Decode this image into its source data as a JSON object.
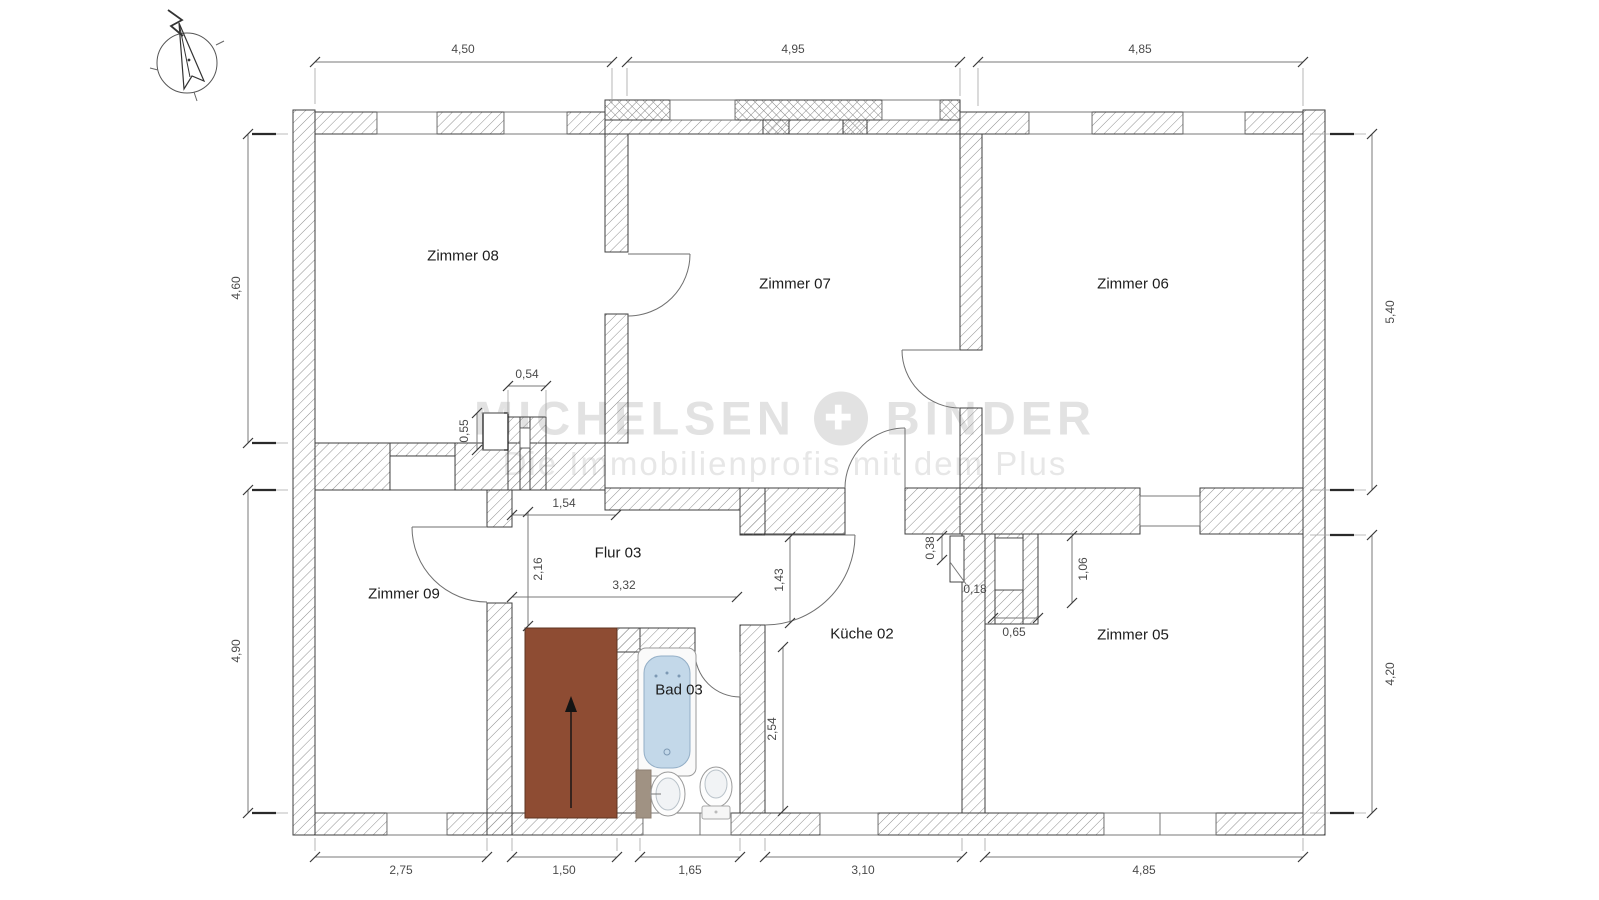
{
  "watermark": {
    "brand_left": "MICHELSEN",
    "plus_symbol": "✚",
    "brand_right": "BINDER",
    "tagline": "Die Immobilienprofis mit dem Plus"
  },
  "rooms": {
    "zimmer08": "Zimmer 08",
    "zimmer07": "Zimmer 07",
    "zimmer06": "Zimmer 06",
    "zimmer09": "Zimmer 09",
    "zimmer05": "Zimmer 05",
    "flur": "Flur 03",
    "kueche": "Küche 02",
    "bad": "Bad 03"
  },
  "dims": {
    "top1": "4,50",
    "top2": "4,95",
    "top3": "4,85",
    "left1": "4,60",
    "left2": "4,90",
    "right1": "5,40",
    "right2": "4,20",
    "bottom1": "2,75",
    "bottom2": "1,50",
    "bottom3": "1,65",
    "bottom4": "3,10",
    "bottom5": "4,85",
    "chimney_w": "0,54",
    "chimney_h": "0,55",
    "flur_top": "1,54",
    "flur_left": "2,16",
    "flur_bottom": "3,32",
    "kueche_door": "1,43",
    "kueche_height": "2,54",
    "shaft_a": "0,38",
    "shaft_b": "0,18",
    "shaft_c": "1,06",
    "shaft_d": "0,65"
  },
  "colors": {
    "stairs_brown": "#8e4c33",
    "tub_blue": "#c3d8e9",
    "watermark_gray": "#e2e2e2"
  }
}
